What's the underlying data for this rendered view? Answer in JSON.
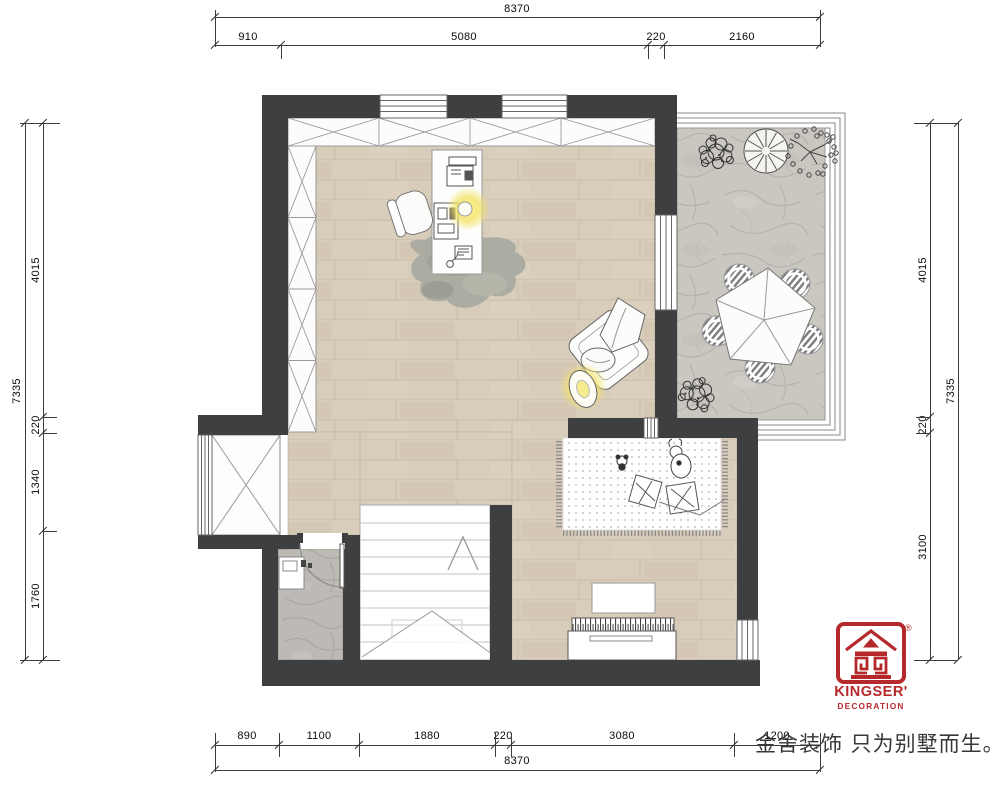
{
  "dimensions": {
    "top": {
      "total": "8370",
      "segments": [
        "910",
        "5080",
        "220",
        "2160"
      ]
    },
    "bottom": {
      "total": "8370",
      "segments": [
        "890",
        "1100",
        "1880",
        "220",
        "3080",
        "1200"
      ]
    },
    "left": {
      "total": "7335",
      "segments": [
        "4015",
        "220",
        "1340",
        "1760"
      ]
    },
    "right": {
      "total": "7335",
      "segments": [
        "4015",
        "220",
        "3100"
      ]
    }
  },
  "branding": {
    "logo_text": "KINGSER'",
    "logo_subtext": "DECORATION",
    "registered": "®",
    "slogan": "金舍装饰 只为别墅而生。",
    "brand_red": "#b5292c"
  },
  "plan_legend": {
    "colors": {
      "wall": "#3e3f41",
      "wood_floor": "#d8ccba",
      "terrace_stone": "#cac7c1",
      "bathroom_stone": "#bdb9b4",
      "lamp_glow": "#f3e469"
    },
    "elements": [
      "wardrobe-cabinets",
      "desk",
      "office-chair",
      "printer",
      "computer",
      "telephone",
      "area-rug",
      "armchair",
      "floor-lamp",
      "terrace",
      "terrace-railing",
      "patio-umbrella-table",
      "patio-stools",
      "plants",
      "play-rug",
      "pillows",
      "teddy-bear",
      "doll",
      "piano",
      "piano-bench",
      "stairs",
      "stairs-up-arrow",
      "bathroom",
      "bathroom-door",
      "wash-basin",
      "shaft",
      "windows"
    ]
  }
}
